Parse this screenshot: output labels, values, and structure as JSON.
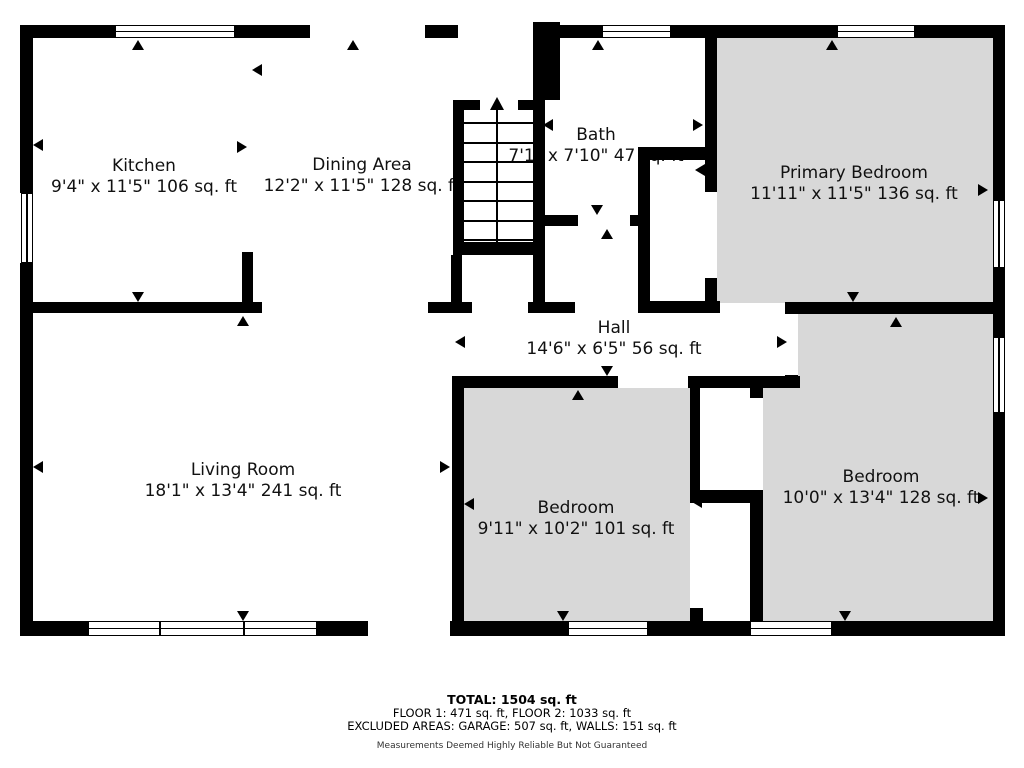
{
  "plan_title": "Floor plan",
  "rooms": [
    {
      "id": "kitchen",
      "name": "Kitchen",
      "dims": "9'4\" x 11'5\" 106 sq. ft"
    },
    {
      "id": "dining-area",
      "name": "Dining Area",
      "dims": "12'2\" x 11'5\" 128 sq. ft"
    },
    {
      "id": "bath",
      "name": "Bath",
      "dims": "7'1\" x 7'10\" 47 sq. ft"
    },
    {
      "id": "primary-bedroom",
      "name": "Primary Bedroom",
      "dims": "11'11\" x 11'5\" 136 sq. ft"
    },
    {
      "id": "hall",
      "name": "Hall",
      "dims": "14'6\" x 6'5\" 56 sq. ft"
    },
    {
      "id": "living-room",
      "name": "Living Room",
      "dims": "18'1\" x 13'4\" 241 sq. ft"
    },
    {
      "id": "bedroom-left",
      "name": "Bedroom",
      "dims": "9'11\" x 10'2\" 101 sq. ft"
    },
    {
      "id": "bedroom-right",
      "name": "Bedroom",
      "dims": "10'0\" x 13'4\" 128 sq. ft"
    }
  ],
  "footer": {
    "total": "TOTAL: 1504 sq. ft",
    "floors": "FLOOR 1: 471 sq. ft, FLOOR 2: 1033 sq. ft",
    "excluded": "EXCLUDED AREAS: GARAGE: 507 sq. ft, WALLS: 151 sq. ft",
    "disclaimer": "Measurements Deemed Highly Reliable But Not Guaranteed"
  },
  "colors": {
    "wall": "#000000",
    "room_fill": "#d8d8d8",
    "background": "#ffffff"
  }
}
